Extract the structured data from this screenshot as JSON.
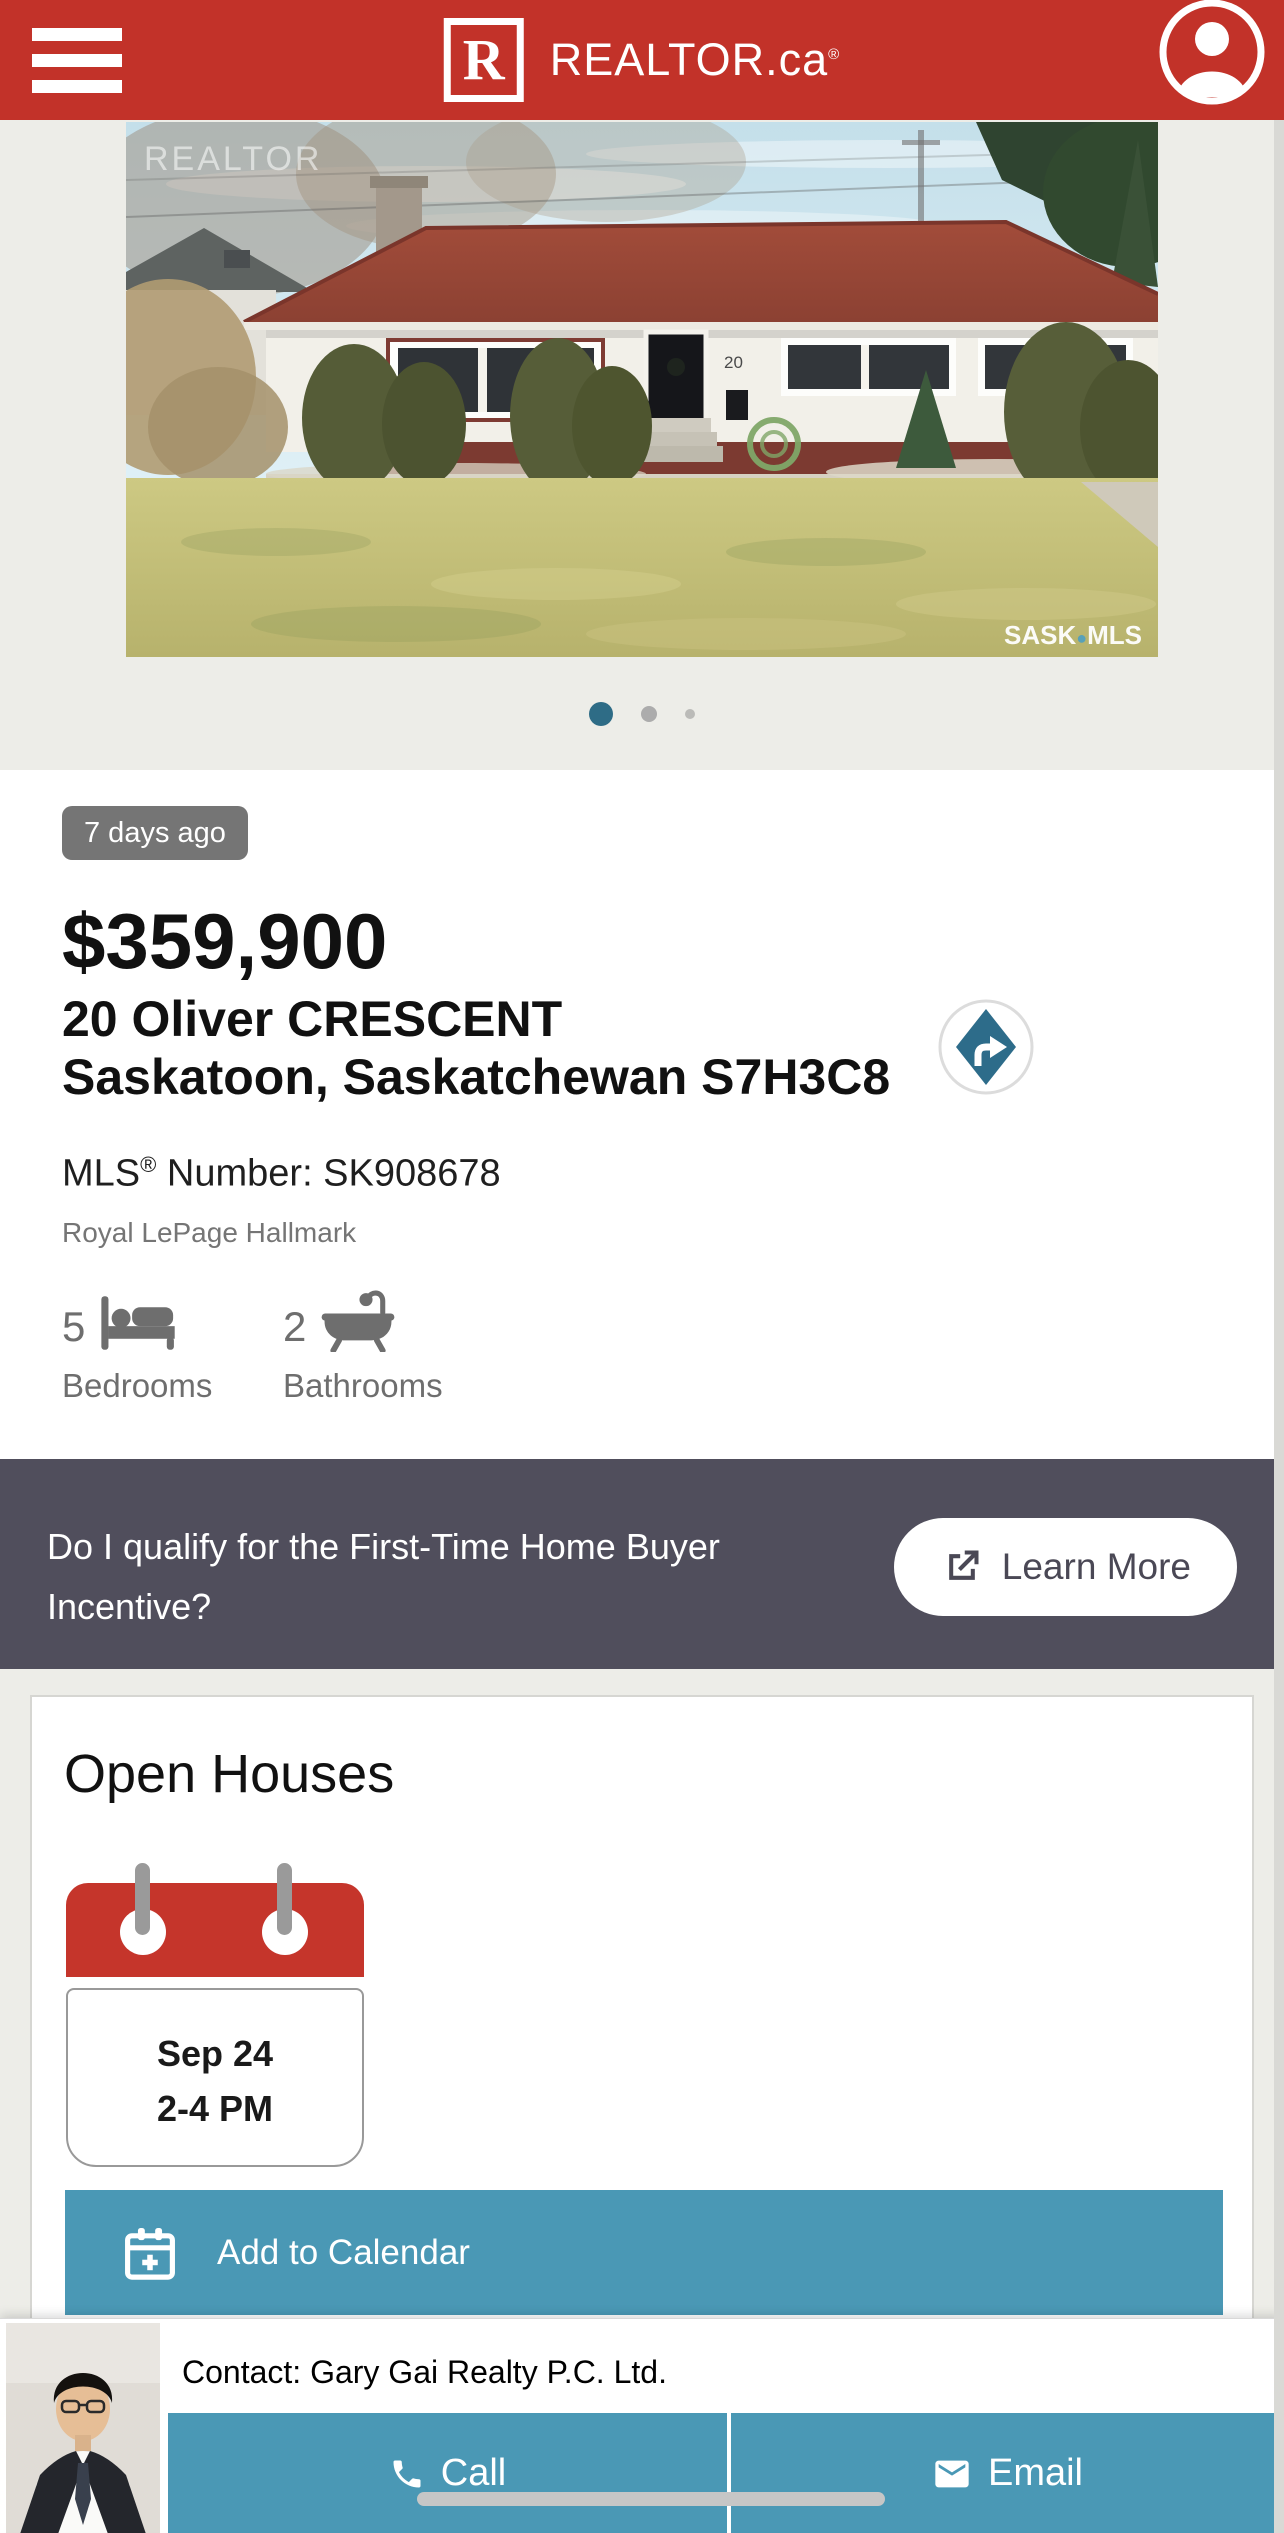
{
  "header": {
    "logo_r": "R",
    "brand": "REALTOR.ca",
    "reg": "®"
  },
  "photo": {
    "watermark_realtor": "REALTOR",
    "house_number": "20",
    "watermark_sask": "SASK",
    "watermark_dot": "●",
    "watermark_mls": "MLS"
  },
  "carousel": {
    "dot_count": 3,
    "active_dot": 1,
    "active_color": "#2E6C86"
  },
  "listing": {
    "posted_badge": "7 days ago",
    "price": "$359,900",
    "address_line1": "20 Oliver CRESCENT",
    "address_line2": "Saskatoon, Saskatchewan S7H3C8",
    "mls_brand": "MLS",
    "mls_reg": "®",
    "mls_text": " Number: SK908678",
    "brokerage": "Royal LePage Hallmark",
    "beds_value": "5",
    "beds_label": "Bedrooms",
    "baths_value": "2",
    "baths_label": "Bathrooms"
  },
  "incentive": {
    "question": "Do I qualify for the First-Time Home Buyer Incentive?",
    "cta": "Learn More"
  },
  "open_house": {
    "title": "Open Houses",
    "date": "Sep 24",
    "time": "2-4 PM",
    "add_to_calendar": "Add to Calendar"
  },
  "contact": {
    "label": "Contact: Gary Gai Realty P.C. Ltd.",
    "call": "Call",
    "email": "Email"
  },
  "colors": {
    "brand_red": "#C23229",
    "calendar_red": "#C5352B",
    "teal": "#4A98B5",
    "banner": "#504E5C",
    "badge": "#757575"
  }
}
